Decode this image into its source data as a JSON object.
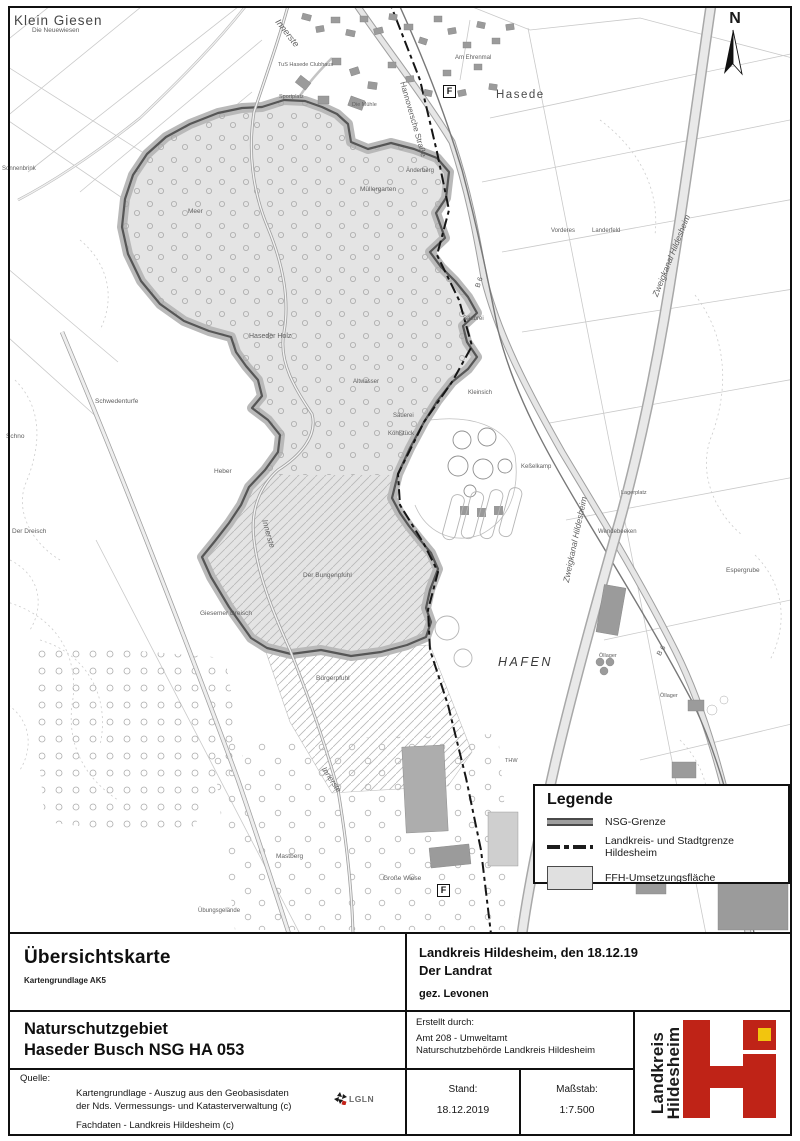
{
  "panel": {
    "uebersicht_title": "Übersichtskarte",
    "kartengrundlage": "Kartengrundlage AK5",
    "nsg_line1": "Naturschutzgebiet",
    "nsg_line2": "Haseder Busch NSG HA 053",
    "quelle_label": "Quelle:",
    "quelle_line1": "Kartengrundlage - Auszug aus den Geobasisdaten",
    "quelle_line2": "der Nds. Vermessungs- und Katasterverwaltung  (c)",
    "quelle_line3": "Fachdaten - Landkreis Hildesheim (c)",
    "lgln_label": "LGLN",
    "issued_line1": "Landkreis Hildesheim, den 18.12.19",
    "issued_line2": "Der Landrat",
    "signed": "gez. Levonen",
    "erstellt_label": "Erstellt durch:",
    "erstellt_line1": "Amt 208 - Umweltamt",
    "erstellt_line2": "Naturschutzbehörde Landkreis Hildesheim",
    "stand_label": "Stand:",
    "stand_value": "18.12.2019",
    "massstab_label": "Maßstab:",
    "massstab_value": "1:7.500"
  },
  "legend": {
    "title": "Legende",
    "items": [
      {
        "label": "NSG-Grenze"
      },
      {
        "label": "Landkreis- und Stadtgrenze Hildesheim"
      },
      {
        "label": "FFH-Umsetzungsfläche"
      }
    ]
  },
  "north": {
    "label": "N"
  },
  "logo": {
    "line1": "Landkreis",
    "line2": "Hildesheim"
  },
  "colors": {
    "ffh_fill": "#e4e4e4",
    "nsg_halo": "#b9b9b9",
    "nsg_line": "#565656",
    "grenze_dash": "#161616",
    "logo_red": "#bf2317",
    "logo_yellow": "#f2c50e"
  },
  "map": {
    "markers": [
      {
        "label": "F",
        "x": 443,
        "y": 85
      },
      {
        "label": "F",
        "x": 437,
        "y": 884
      }
    ],
    "labels": [
      {
        "t": "Klein Giesen",
        "x": 14,
        "y": 14,
        "s": 13.5,
        "c": "#464646",
        "ls": 1
      },
      {
        "t": "Die Neuewiesen",
        "x": 32,
        "y": 28,
        "s": 6.5
      },
      {
        "t": "Sonnenbrink",
        "x": 2,
        "y": 166,
        "s": 6
      },
      {
        "t": "Innerste",
        "x": 277,
        "y": 16,
        "s": 9,
        "r": 52,
        "i": true
      },
      {
        "t": "TuS Hasede Clubhaus",
        "x": 278,
        "y": 63,
        "s": 5.5
      },
      {
        "t": "Sportplatz",
        "x": 279,
        "y": 95,
        "s": 5.5
      },
      {
        "t": "Die Mühle",
        "x": 352,
        "y": 103,
        "s": 5.5
      },
      {
        "t": "Hannoversche Straße",
        "x": 402,
        "y": 78,
        "s": 8,
        "r": 74
      },
      {
        "t": "Am Ehrenmal",
        "x": 455,
        "y": 55,
        "s": 6
      },
      {
        "t": "Hasede",
        "x": 496,
        "y": 90,
        "s": 11.5,
        "c": "#4a4a4a",
        "ls": 1.5
      },
      {
        "t": "Änderberg",
        "x": 406,
        "y": 168,
        "s": 6
      },
      {
        "t": "Müllergarten",
        "x": 360,
        "y": 187,
        "s": 6.5
      },
      {
        "t": "Meer",
        "x": 188,
        "y": 209,
        "s": 6.5
      },
      {
        "t": "Vorderes",
        "x": 551,
        "y": 228,
        "s": 6
      },
      {
        "t": "Landerfeld",
        "x": 592,
        "y": 228,
        "s": 6
      },
      {
        "t": "Zweigkanal Hildesheim",
        "x": 655,
        "y": 292,
        "s": 8.5,
        "r": -68,
        "i": true
      },
      {
        "t": "B 6",
        "x": 478,
        "y": 284,
        "s": 7,
        "r": -72
      },
      {
        "t": "Haseder Holz",
        "x": 249,
        "y": 333,
        "s": 7
      },
      {
        "t": "Säubrei",
        "x": 463,
        "y": 316,
        "s": 6
      },
      {
        "t": "Altwasser",
        "x": 353,
        "y": 379,
        "s": 6
      },
      {
        "t": "Kleinsich",
        "x": 468,
        "y": 390,
        "s": 6
      },
      {
        "t": "Säuerei",
        "x": 393,
        "y": 413,
        "s": 6
      },
      {
        "t": "Köhlstück",
        "x": 388,
        "y": 431,
        "s": 6
      },
      {
        "t": "Keßelkamp",
        "x": 521,
        "y": 464,
        "s": 6
      },
      {
        "t": "Schwedenturfe",
        "x": 95,
        "y": 399,
        "s": 6.5
      },
      {
        "t": "Schno",
        "x": 6,
        "y": 434,
        "s": 6.5
      },
      {
        "t": "Heber",
        "x": 214,
        "y": 469,
        "s": 6.5
      },
      {
        "t": "Der Dreisch",
        "x": 12,
        "y": 529,
        "s": 6.5
      },
      {
        "t": "Lagerplatz",
        "x": 621,
        "y": 491,
        "s": 5.5
      },
      {
        "t": "Zweigkanal Hildesheim",
        "x": 566,
        "y": 578,
        "s": 8.5,
        "r": -78,
        "i": true
      },
      {
        "t": "Wendebeeken",
        "x": 598,
        "y": 529,
        "s": 6
      },
      {
        "t": "Espergrube",
        "x": 726,
        "y": 568,
        "s": 6.5
      },
      {
        "t": "Innerste",
        "x": 264,
        "y": 516,
        "s": 8,
        "r": 74,
        "i": true
      },
      {
        "t": "Der Bungenpfuhl",
        "x": 303,
        "y": 573,
        "s": 6.5
      },
      {
        "t": "Giesemer Dreisch",
        "x": 200,
        "y": 611,
        "s": 6.5
      },
      {
        "t": "Bürgerpfuhl",
        "x": 316,
        "y": 676,
        "s": 6.5
      },
      {
        "t": "HAFEN",
        "x": 498,
        "y": 656,
        "s": 12.5,
        "i": true,
        "ls": 2.5,
        "c": "#3a3a3a"
      },
      {
        "t": "Öllager",
        "x": 599,
        "y": 654,
        "s": 5.5
      },
      {
        "t": "B 6",
        "x": 659,
        "y": 652,
        "s": 7,
        "r": -58
      },
      {
        "t": "Öllager",
        "x": 660,
        "y": 694,
        "s": 5.5
      },
      {
        "t": "THW",
        "x": 505,
        "y": 759,
        "s": 5.5
      },
      {
        "t": "Innerste",
        "x": 323,
        "y": 764,
        "s": 8,
        "r": 56,
        "i": true
      },
      {
        "t": "Mastberg",
        "x": 276,
        "y": 854,
        "s": 6.5
      },
      {
        "t": "Große Wiese",
        "x": 383,
        "y": 876,
        "s": 6.5
      },
      {
        "t": "Übungsgelände",
        "x": 198,
        "y": 908,
        "s": 6
      }
    ]
  }
}
